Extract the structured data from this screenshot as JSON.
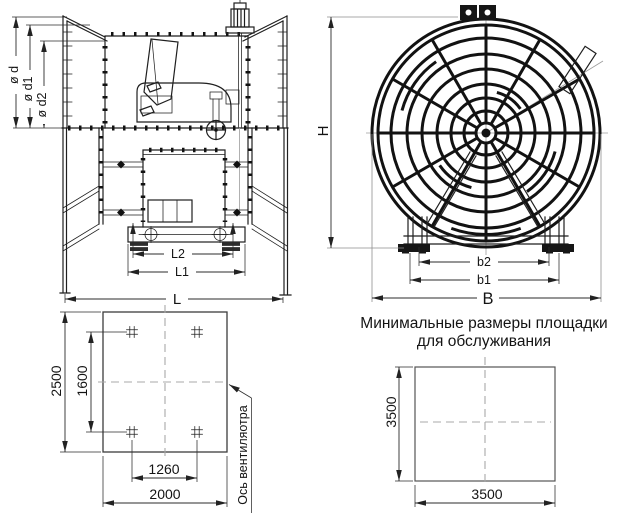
{
  "colors": {
    "line": "#1f1f1f",
    "dim": "#2b2b2b",
    "centerline": "#9c9c9c",
    "background": "#ffffff"
  },
  "side_view": {
    "dim_d": "ø d",
    "dim_d1": "ø d1",
    "dim_d2": "ø d2",
    "dim_L2": "L2",
    "dim_L1": "L1",
    "dim_L": "L"
  },
  "front_view": {
    "dim_H": "H",
    "dim_b2": "b2",
    "dim_b1": "b1",
    "dim_B": "B"
  },
  "foundation_plan": {
    "dim_height": "2500",
    "dim_bolt_rows": "1600",
    "dim_bolt_cols": "1260",
    "dim_width": "2000",
    "axis_label": "Ось вентиляотра"
  },
  "service_platform": {
    "title_line1": "Минимальные размеры площадки",
    "title_line2": "для обслуживания",
    "dim_height": "3500",
    "dim_width": "3500"
  }
}
